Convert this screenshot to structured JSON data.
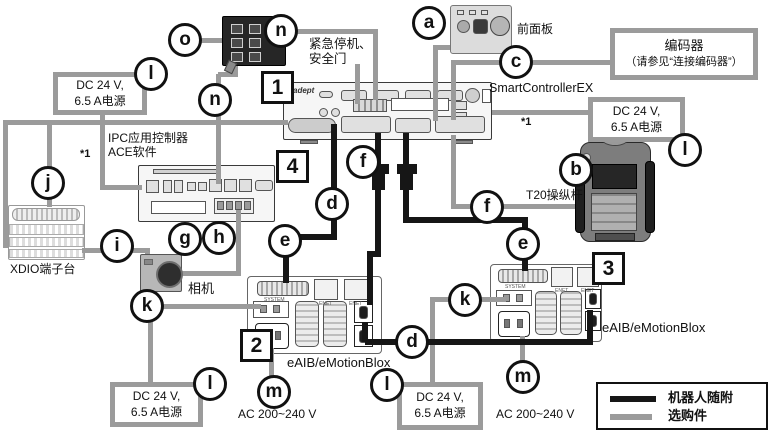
{
  "diagram_title_implicit": "SmartControllerEX system connection diagram",
  "callouts": {
    "a": "a",
    "b": "b",
    "c": "c",
    "d": "d",
    "e": "e",
    "f": "f",
    "g": "g",
    "h": "h",
    "i": "i",
    "j": "j",
    "k": "k",
    "l": "l",
    "m": "m",
    "n": "n",
    "o": "o"
  },
  "numbers": {
    "box1": "1",
    "box2": "2",
    "box3": "3",
    "box4": "4"
  },
  "labels": {
    "emergency_line1": "紧急停机、",
    "emergency_line2": "安全门",
    "front_panel": "前面板",
    "encoder_line1": "编码器",
    "encoder_line2": "（请参见“连接编码器”）",
    "smart_controller": "SmartControllerEX",
    "ipc_line1": "IPC应用控制器",
    "ipc_line2": "ACE软件",
    "t20": "T20操纵杆",
    "xdio": "XDIO端子台",
    "camera": "相机",
    "eaib_left": "eAIB/eMotionBlox",
    "eaib_right": "eAIB/eMotionBlox",
    "ac_left": "AC 200~240 V",
    "ac_right": "AC 200~240 V",
    "footnote": "*1",
    "adept_logo": "adept"
  },
  "power_box": {
    "line1": "DC 24 V,",
    "line2": "6.5 A电源"
  },
  "port_labels": {
    "system": "SYSTEM",
    "enet": "ENET"
  },
  "legend": {
    "robot_included": "机器人随附",
    "optional": "选购件"
  },
  "colors": {
    "wire_optional": "#9b9b9b",
    "wire_robot_included": "#161616"
  }
}
